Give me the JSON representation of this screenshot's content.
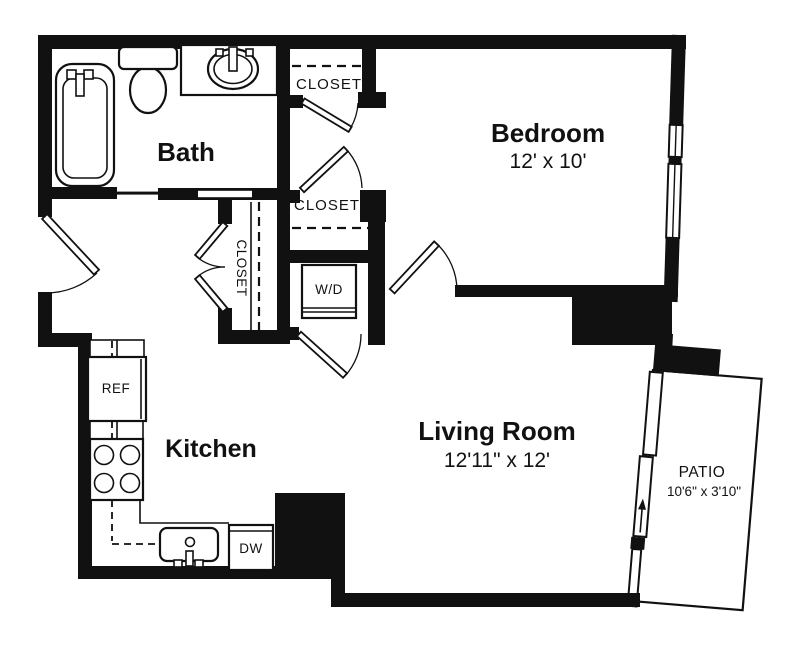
{
  "rooms": {
    "bath": {
      "label": "Bath"
    },
    "bedroom": {
      "label": "Bedroom",
      "dims": "12' x 10'"
    },
    "living_room": {
      "label": "Living Room",
      "dims": "12'11\" x 12'"
    },
    "kitchen": {
      "label": "Kitchen"
    },
    "patio": {
      "label": "PATIO",
      "dims": "10'6\" x 3'10\""
    }
  },
  "closets": {
    "bedroom_top": "CLOSET",
    "bedroom_middle": "CLOSET",
    "hall": "CLOSET"
  },
  "appliances": {
    "refrigerator": "REF",
    "dishwasher": "DW",
    "washer_dryer": "W/D"
  },
  "colors": {
    "wall": "#111111",
    "background": "#ffffff"
  }
}
